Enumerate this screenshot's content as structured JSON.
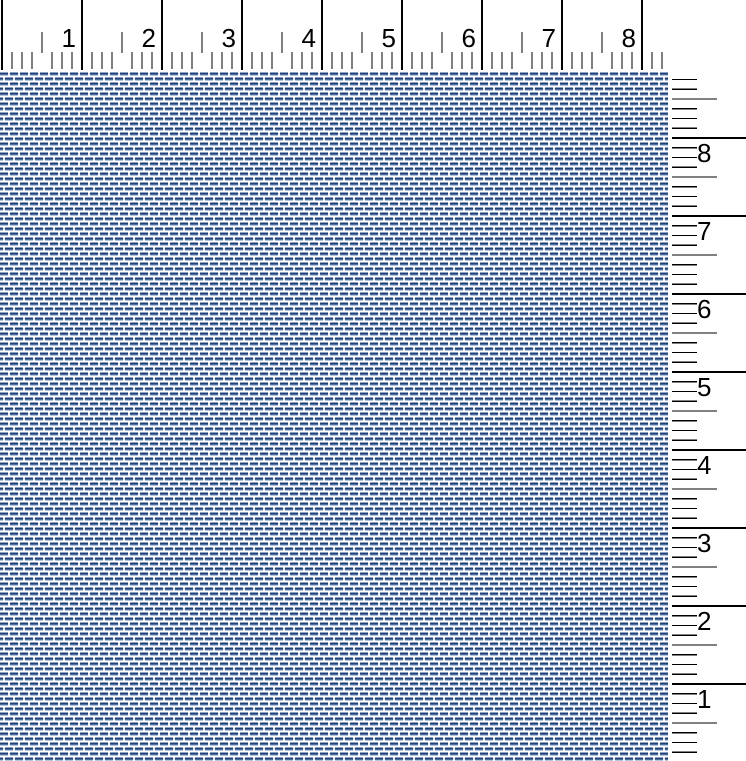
{
  "view": {
    "name": "weaving drawdown preview with rulers",
    "width_px": 746,
    "height_px": 761
  },
  "top_ruler": {
    "labels": [
      "1",
      "2",
      "3",
      "4",
      "5",
      "6",
      "7",
      "8"
    ],
    "origin_px": 2,
    "unit_px": 80,
    "subdivisions_per_unit": 8,
    "tick_extent_px": 662,
    "tick_color": "#000000",
    "major_span": [
      0,
      70
    ],
    "half_span": [
      32,
      53
    ],
    "fine_span": [
      52,
      69
    ],
    "label_font_px": 26,
    "label_baseline_y": 47,
    "label_gap_px": 6
  },
  "right_ruler": {
    "labels": [
      "8",
      "7",
      "6",
      "5",
      "4",
      "3",
      "2",
      "1"
    ],
    "first_major_y": 66,
    "unit_px": 78,
    "subdivisions_per_unit": 8,
    "line_start_x": 4,
    "major_len": 77,
    "half_len": 45,
    "fine_len": 25,
    "tick_color": "#000000",
    "label_font_px": 26,
    "label_x": 29,
    "label_baseline_offset": 24
  },
  "weave": {
    "background": "#ffffff",
    "dash_row_colors": [
      "#8da3c6",
      "#24406e",
      "#4a6da1",
      "#b6c3da"
    ],
    "speck_color": "#d3dce9",
    "tile_width": 10,
    "tile_height": 10,
    "dash_width": 8,
    "dash_height": 4,
    "row_offset_x": 5,
    "row_offset_y": 5
  }
}
